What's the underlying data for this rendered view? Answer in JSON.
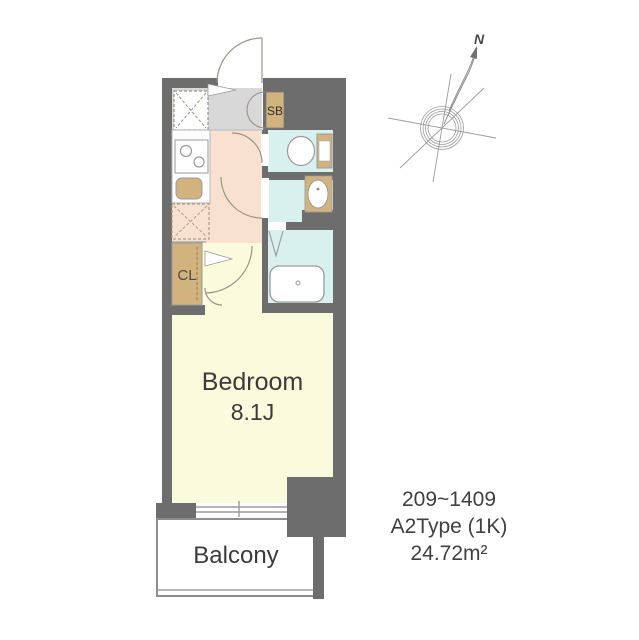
{
  "floor_plan": {
    "rooms": {
      "bedroom": {
        "label": "Bedroom",
        "size": "8.1J"
      },
      "balcony": {
        "label": "Balcony"
      },
      "closet": {
        "label": "CL"
      },
      "shoe_box": {
        "label": "SB"
      }
    },
    "unit_info": {
      "floor_range": "209~1409",
      "unit_type": "A2Type (1K)",
      "floor_area": "24.72m²"
    },
    "compass": {
      "north_label": "N"
    },
    "colors": {
      "wall": "#6d6d6d",
      "bedroom_floor": "#fafadc",
      "kitchen_floor": "#f8e2cf",
      "wet_area_floor": "#d8f0ee",
      "entrance_floor": "#d8d8d8",
      "fixture_tan": "#d2b37e",
      "line_gray": "#9a9a9a",
      "text": "#3b3b3b"
    },
    "icons": {
      "compass": "compass-rose-icon",
      "washing_machine": "washing-machine-space-icon",
      "refrigerator": "refrigerator-space-icon",
      "stove": "stove-icon",
      "sink": "kitchen-sink-icon",
      "toilet": "toilet-icon",
      "washbasin": "washbasin-icon",
      "bathtub": "bathtub-icon"
    }
  }
}
